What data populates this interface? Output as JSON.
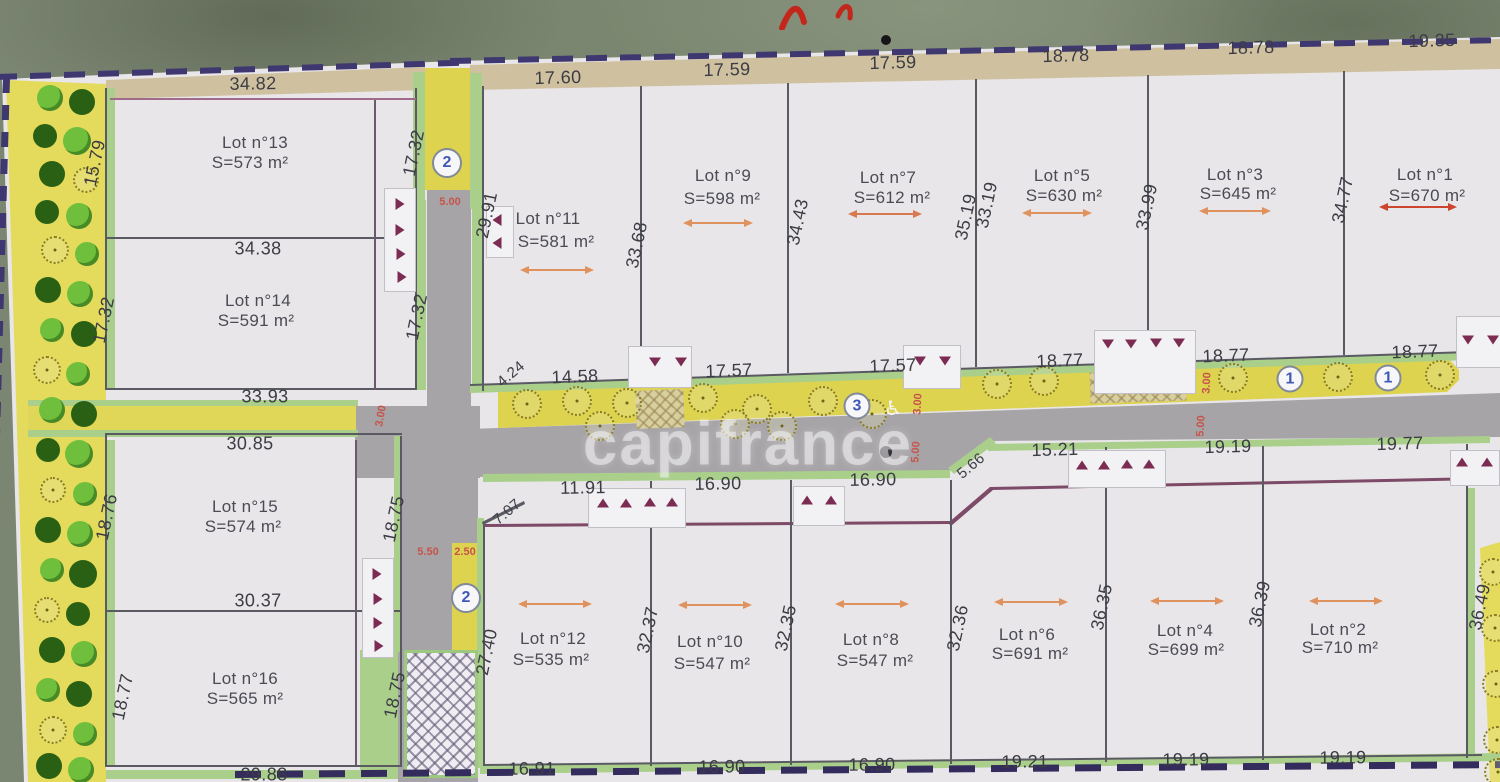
{
  "watermark": "capifrance",
  "icons": {
    "wheelchair_icon": "♿",
    "tree_icon": "tree",
    "handwriting_icon": "red-pen-stroke"
  },
  "colors": {
    "boundary_dash": "#3f3770",
    "road": "#a7a4a8",
    "planting_strip": "#e2d95b",
    "lot_edge_green": "#a9cf8b",
    "tan_band": "#cfc1a0",
    "marker_triangle": "#7c2c52",
    "red_annotation": "#c6544a",
    "arrow_orange": "#e0925e",
    "arrow_red": "#ce452f",
    "circled_number_text": "#3f58b5"
  },
  "lots": [
    {
      "name": "Lot n°13",
      "area": "S=573 m²",
      "nx": 255,
      "ny": 143,
      "ax": 250,
      "ay": 163
    },
    {
      "name": "Lot n°14",
      "area": "S=591 m²",
      "nx": 258,
      "ny": 301,
      "ax": 256,
      "ay": 321
    },
    {
      "name": "Lot n°15",
      "area": "S=574 m²",
      "nx": 245,
      "ny": 507,
      "ax": 243,
      "ay": 527
    },
    {
      "name": "Lot n°16",
      "area": "S=565 m²",
      "nx": 245,
      "ny": 679,
      "ax": 245,
      "ay": 699
    },
    {
      "name": "Lot n°11",
      "area": "S=581 m²",
      "nx": 548,
      "ny": 219,
      "ax": 556,
      "ay": 242,
      "arw": [
        557,
        269,
        58,
        "#e0925e"
      ]
    },
    {
      "name": "Lot n°9",
      "area": "S=598 m²",
      "nx": 723,
      "ny": 176,
      "ax": 722,
      "ay": 199,
      "arw": [
        718,
        222,
        54,
        "#e0925e"
      ]
    },
    {
      "name": "Lot n°7",
      "area": "S=612 m²",
      "nx": 888,
      "ny": 178,
      "ax": 892,
      "ay": 198,
      "arw": [
        885,
        213,
        58,
        "#d77a50"
      ]
    },
    {
      "name": "Lot n°5",
      "area": "S=630 m²",
      "nx": 1062,
      "ny": 176,
      "ax": 1064,
      "ay": 196,
      "arw": [
        1057,
        212,
        54,
        "#e0925e"
      ]
    },
    {
      "name": "Lot n°3",
      "area": "S=645 m²",
      "nx": 1235,
      "ny": 175,
      "ax": 1238,
      "ay": 194,
      "arw": [
        1235,
        210,
        56,
        "#e0925e"
      ]
    },
    {
      "name": "Lot n°1",
      "area": "S=670 m²",
      "nx": 1425,
      "ny": 175,
      "ax": 1427,
      "ay": 196,
      "arw": [
        1418,
        206,
        62,
        "#ce452f"
      ]
    },
    {
      "name": "Lot n°12",
      "area": "S=535 m²",
      "nx": 553,
      "ny": 639,
      "ax": 551,
      "ay": 660,
      "arw": [
        555,
        603,
        58,
        "#e0925e"
      ]
    },
    {
      "name": "Lot n°10",
      "area": "S=547 m²",
      "nx": 710,
      "ny": 642,
      "ax": 712,
      "ay": 664,
      "arw": [
        715,
        604,
        58,
        "#e0925e"
      ]
    },
    {
      "name": "Lot n°8",
      "area": "S=547 m²",
      "nx": 871,
      "ny": 640,
      "ax": 875,
      "ay": 661,
      "arw": [
        872,
        603,
        58,
        "#e0925e"
      ]
    },
    {
      "name": "Lot n°6",
      "area": "S=691 m²",
      "nx": 1027,
      "ny": 635,
      "ax": 1030,
      "ay": 654,
      "arw": [
        1031,
        601,
        58,
        "#e0925e"
      ]
    },
    {
      "name": "Lot n°4",
      "area": "S=699 m²",
      "nx": 1185,
      "ny": 631,
      "ax": 1186,
      "ay": 650,
      "arw": [
        1187,
        600,
        58,
        "#e0925e"
      ]
    },
    {
      "name": "Lot n°2",
      "area": "S=710 m²",
      "nx": 1338,
      "ny": 630,
      "ax": 1340,
      "ay": 648,
      "arw": [
        1346,
        600,
        58,
        "#e0925e"
      ]
    }
  ],
  "dims_h": [
    [
      "34.82",
      253,
      84,
      -1
    ],
    [
      "17.60",
      558,
      78,
      -1.5
    ],
    [
      "17.59",
      727,
      70,
      -1.5
    ],
    [
      "17.59",
      893,
      63,
      -1.5
    ],
    [
      "18.78",
      1066,
      56,
      -1.5
    ],
    [
      "18.78",
      1251,
      48,
      -1.5
    ],
    [
      "19.35",
      1432,
      41,
      -1.5
    ],
    [
      "14.58",
      575,
      377,
      -2
    ],
    [
      "17.57",
      729,
      371,
      -2
    ],
    [
      "17.57",
      893,
      366,
      -2
    ],
    [
      "18.77",
      1060,
      361,
      -2
    ],
    [
      "18.77",
      1226,
      356,
      -2
    ],
    [
      "18.77",
      1415,
      352,
      -2
    ],
    [
      "34.38",
      258,
      249,
      0
    ],
    [
      "33.93",
      265,
      397,
      0
    ],
    [
      "30.85",
      250,
      444,
      0
    ],
    [
      "30.37",
      258,
      601,
      0
    ],
    [
      "29.88",
      264,
      775,
      0
    ],
    [
      "11.91",
      583,
      488,
      -1
    ],
    [
      "16.90",
      718,
      484,
      -1
    ],
    [
      "16.90",
      873,
      480,
      -1
    ],
    [
      "15.21",
      1055,
      450,
      -1.5
    ],
    [
      "19.19",
      1228,
      447,
      -1.5
    ],
    [
      "19.77",
      1400,
      444,
      -1.5
    ],
    [
      "16.91",
      532,
      769,
      -0.5
    ],
    [
      "16.90",
      722,
      767,
      -0.5
    ],
    [
      "16.90",
      872,
      765,
      -0.5
    ],
    [
      "19.21",
      1025,
      762,
      -0.5
    ],
    [
      "19.19",
      1186,
      760,
      -0.5
    ],
    [
      "19.19",
      1343,
      758,
      -0.5
    ]
  ],
  "dims_v": [
    [
      "15.79",
      95,
      163
    ],
    [
      "17.32",
      104,
      320
    ],
    [
      "17.32",
      414,
      153
    ],
    [
      "17.32",
      417,
      317
    ],
    [
      "29.91",
      487,
      215
    ],
    [
      "33.68",
      637,
      245
    ],
    [
      "34.43",
      798,
      222
    ],
    [
      "35.19",
      966,
      217
    ],
    [
      "33.19",
      987,
      205
    ],
    [
      "33.99",
      1147,
      207
    ],
    [
      "34.77",
      1343,
      200
    ],
    [
      "18.76",
      107,
      517
    ],
    [
      "18.77",
      123,
      697
    ],
    [
      "18.75",
      394,
      519
    ],
    [
      "18.75",
      395,
      695
    ],
    [
      "27.40",
      487,
      652
    ],
    [
      "32.37",
      648,
      630
    ],
    [
      "32.35",
      786,
      628
    ],
    [
      "32.36",
      958,
      628
    ],
    [
      "36.35",
      1102,
      607
    ],
    [
      "36.39",
      1260,
      604
    ],
    [
      "36.49",
      1480,
      607
    ]
  ],
  "dims_d": [
    [
      "4.24",
      511,
      374
    ],
    [
      "7.07",
      507,
      512
    ],
    [
      "5.66",
      971,
      466
    ]
  ],
  "dims_red": [
    [
      "5.00",
      450,
      202,
      0
    ],
    [
      "3.00",
      918,
      404,
      -87
    ],
    [
      "5.00",
      916,
      452,
      -87
    ],
    [
      "3.00",
      1207,
      383,
      -87
    ],
    [
      "5.00",
      1201,
      426,
      -87
    ],
    [
      "3.00",
      381,
      416,
      -80
    ],
    [
      "5.50",
      428,
      552,
      0
    ],
    [
      "2.50",
      465,
      552,
      0
    ]
  ],
  "circled_numbers": [
    {
      "n": "2",
      "x": 447,
      "y": 163,
      "d": 30
    },
    {
      "n": "2",
      "x": 466,
      "y": 598,
      "d": 30
    },
    {
      "n": "3",
      "x": 857,
      "y": 406,
      "d": 27
    },
    {
      "n": "1",
      "x": 1290,
      "y": 379,
      "d": 27
    },
    {
      "n": "1",
      "x": 1388,
      "y": 378,
      "d": 27
    }
  ],
  "markers": {
    "down": [
      [
        655,
        362
      ],
      [
        681,
        362
      ],
      [
        920,
        361
      ],
      [
        945,
        361
      ],
      [
        1108,
        344
      ],
      [
        1131,
        344
      ],
      [
        1156,
        343
      ],
      [
        1179,
        343
      ],
      [
        1468,
        340
      ],
      [
        1493,
        340
      ]
    ],
    "up": [
      [
        603,
        503
      ],
      [
        626,
        503
      ],
      [
        650,
        502
      ],
      [
        672,
        502
      ],
      [
        807,
        500
      ],
      [
        831,
        500
      ],
      [
        1082,
        465
      ],
      [
        1104,
        465
      ],
      [
        1127,
        464
      ],
      [
        1149,
        464
      ],
      [
        1462,
        462
      ],
      [
        1487,
        462
      ]
    ],
    "right": [
      [
        400,
        204
      ],
      [
        400,
        230
      ],
      [
        401,
        254
      ],
      [
        402,
        277
      ],
      [
        377,
        574
      ],
      [
        378,
        599
      ],
      [
        378,
        623
      ],
      [
        379,
        646
      ]
    ],
    "left": [
      [
        497,
        220
      ],
      [
        497,
        243
      ]
    ]
  },
  "marker_boxes": [
    [
      628,
      346,
      64,
      42
    ],
    [
      903,
      345,
      58,
      44
    ],
    [
      1094,
      330,
      102,
      64
    ],
    [
      1456,
      316,
      46,
      52
    ],
    [
      588,
      488,
      98,
      40
    ],
    [
      793,
      486,
      52,
      40
    ],
    [
      1068,
      450,
      98,
      38
    ],
    [
      1450,
      450,
      50,
      36
    ],
    [
      384,
      188,
      32,
      104
    ],
    [
      486,
      206,
      28,
      52
    ],
    [
      362,
      558,
      32,
      100
    ]
  ],
  "trees": {
    "north_strip": [
      [
        527,
        404
      ],
      [
        577,
        401
      ],
      [
        627,
        403
      ],
      [
        703,
        398
      ],
      [
        757,
        409
      ],
      [
        823,
        401
      ],
      [
        872,
        414
      ],
      [
        600,
        426
      ],
      [
        735,
        424
      ],
      [
        782,
        426
      ],
      [
        997,
        384
      ],
      [
        1044,
        381
      ],
      [
        1233,
        378
      ],
      [
        1338,
        377
      ],
      [
        1440,
        375
      ]
    ],
    "right_strip": [
      [
        1493,
        572
      ],
      [
        1495,
        628
      ],
      [
        1496,
        684
      ],
      [
        1497,
        740
      ],
      [
        1498,
        772
      ]
    ],
    "left_strip": [
      [
        50,
        98,
        "l",
        26
      ],
      [
        82,
        102,
        "d",
        26
      ],
      [
        45,
        136,
        "d",
        24
      ],
      [
        77,
        141,
        "l",
        28
      ],
      [
        52,
        174,
        "d",
        26
      ],
      [
        86,
        180,
        "o",
        26
      ],
      [
        47,
        212,
        "d",
        24
      ],
      [
        79,
        216,
        "l",
        26
      ],
      [
        55,
        250,
        "o",
        28
      ],
      [
        87,
        254,
        "l",
        24
      ],
      [
        48,
        290,
        "d",
        26
      ],
      [
        80,
        294,
        "l",
        26
      ],
      [
        52,
        330,
        "l",
        24
      ],
      [
        84,
        334,
        "d",
        26
      ],
      [
        47,
        370,
        "o",
        28
      ],
      [
        78,
        374,
        "l",
        24
      ],
      [
        52,
        410,
        "l",
        26
      ],
      [
        84,
        414,
        "d",
        26
      ],
      [
        48,
        450,
        "d",
        24
      ],
      [
        79,
        454,
        "l",
        28
      ],
      [
        53,
        490,
        "o",
        26
      ],
      [
        85,
        494,
        "l",
        24
      ],
      [
        48,
        530,
        "d",
        26
      ],
      [
        80,
        534,
        "l",
        26
      ],
      [
        52,
        570,
        "l",
        24
      ],
      [
        83,
        574,
        "d",
        28
      ],
      [
        47,
        610,
        "o",
        26
      ],
      [
        78,
        614,
        "d",
        24
      ],
      [
        52,
        650,
        "d",
        26
      ],
      [
        84,
        654,
        "l",
        26
      ],
      [
        48,
        690,
        "l",
        24
      ],
      [
        79,
        694,
        "d",
        26
      ],
      [
        53,
        730,
        "o",
        28
      ],
      [
        85,
        734,
        "l",
        24
      ],
      [
        49,
        766,
        "d",
        26
      ],
      [
        81,
        770,
        "l",
        26
      ]
    ]
  },
  "photo_dots": [
    [
      886,
      40,
      10
    ],
    [
      886,
      452,
      12
    ]
  ]
}
